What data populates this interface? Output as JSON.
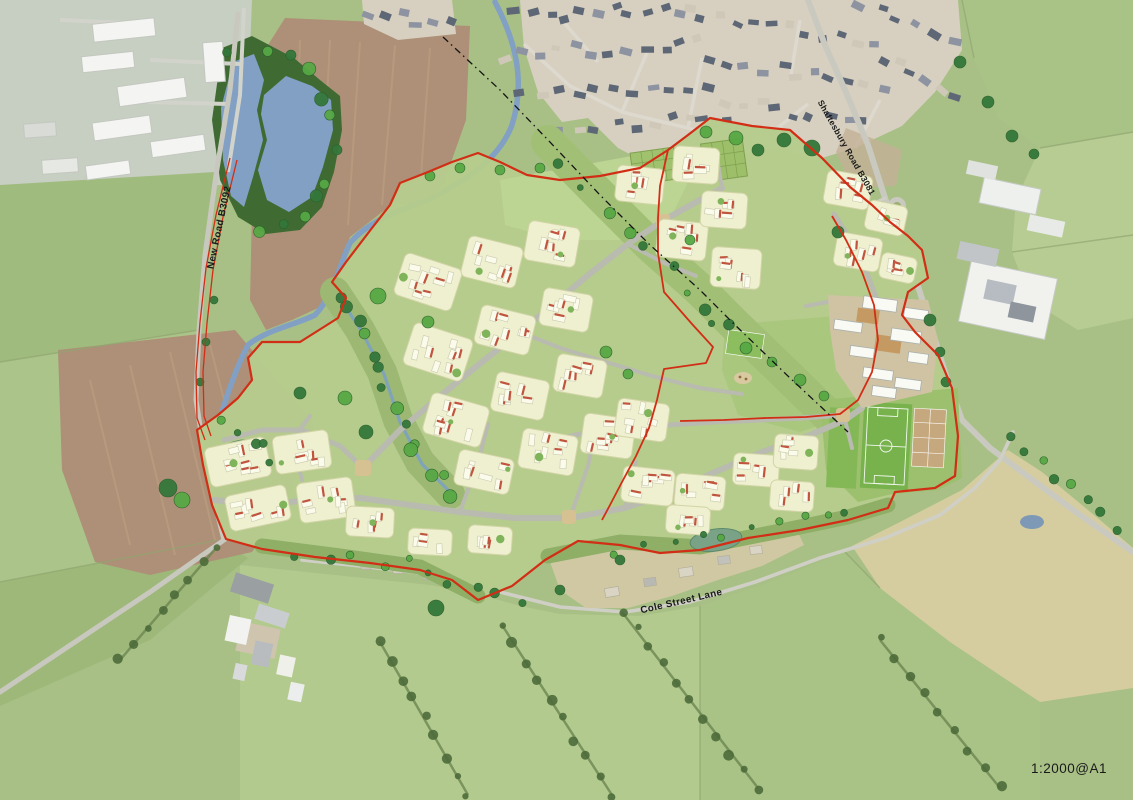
{
  "map": {
    "labels": {
      "new_road": "New Road B3092",
      "shaftesbury_road": "Shaftesbury Road B3081",
      "cole_street_lane": "Cole Street Lane",
      "scale": "1:2000@A1"
    },
    "palette": {
      "boundary_red": "#d22d15",
      "water_blue": "#82a0c4",
      "site_green": "#b5cc8c",
      "parcel_cream": "#eef0d0",
      "house_white": "#fbfbec",
      "roof_red": "#c0543e",
      "pitch_green": "#77b24c",
      "court_tan": "#c6a87e",
      "pond_teal": "#79a287",
      "field_brown": "#ad9077",
      "pale_field": "#d5cda0",
      "road_grey": "#b9bab0",
      "town_roof_slate": "#5e6775",
      "tree_bright": "#57a844",
      "tree_dark": "#34773a",
      "label_black": "#1a1a1a"
    }
  }
}
